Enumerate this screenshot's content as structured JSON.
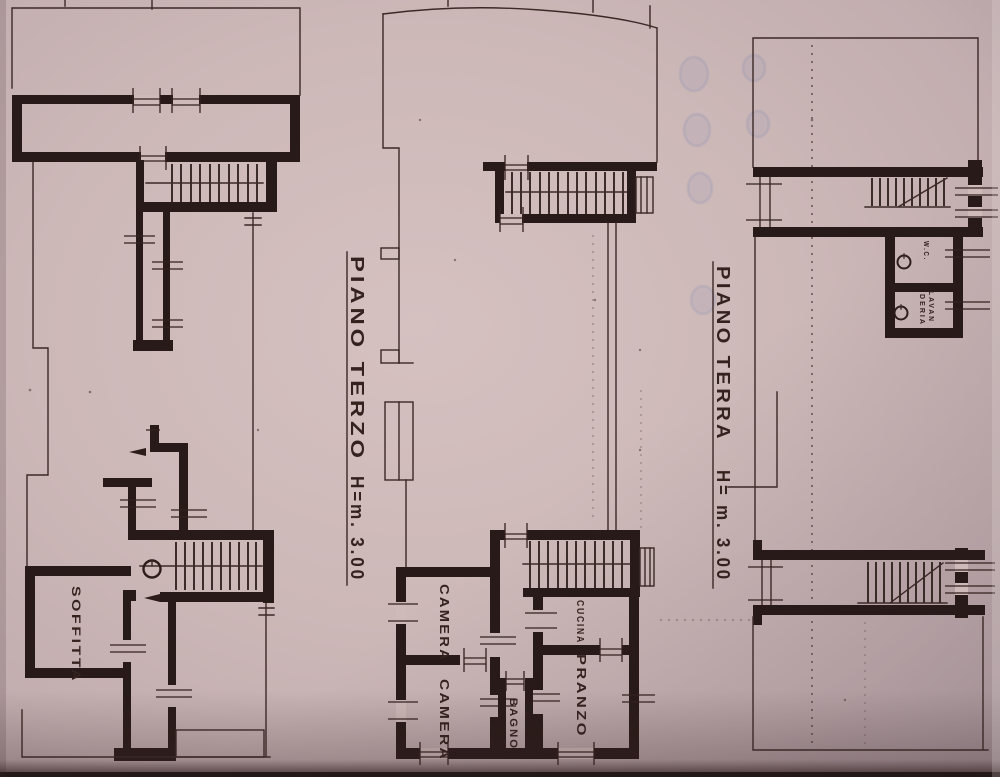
{
  "document": {
    "kind": "scanned architectural floor plan sheet",
    "ink_color": "#281a18",
    "paper_color": "#cdb8b8"
  },
  "captions": {
    "piano_terzo": {
      "title": "PIANO TERZO",
      "height": "H=m. 3.00"
    },
    "piano_terra": {
      "title": "PIANO TERRA",
      "height": "H= m. 3.00"
    }
  },
  "rooms": {
    "soffitta": "SOFFITTA",
    "camera_1": "CAMERA",
    "camera_2": "CAMERA",
    "bagno": "BAGNO",
    "cucina": "CUCINA",
    "pranzo": "PRANZO",
    "wc": "W.C.",
    "lavanderia_line1": "LAVAN",
    "lavanderia_line2": "DERIA"
  }
}
